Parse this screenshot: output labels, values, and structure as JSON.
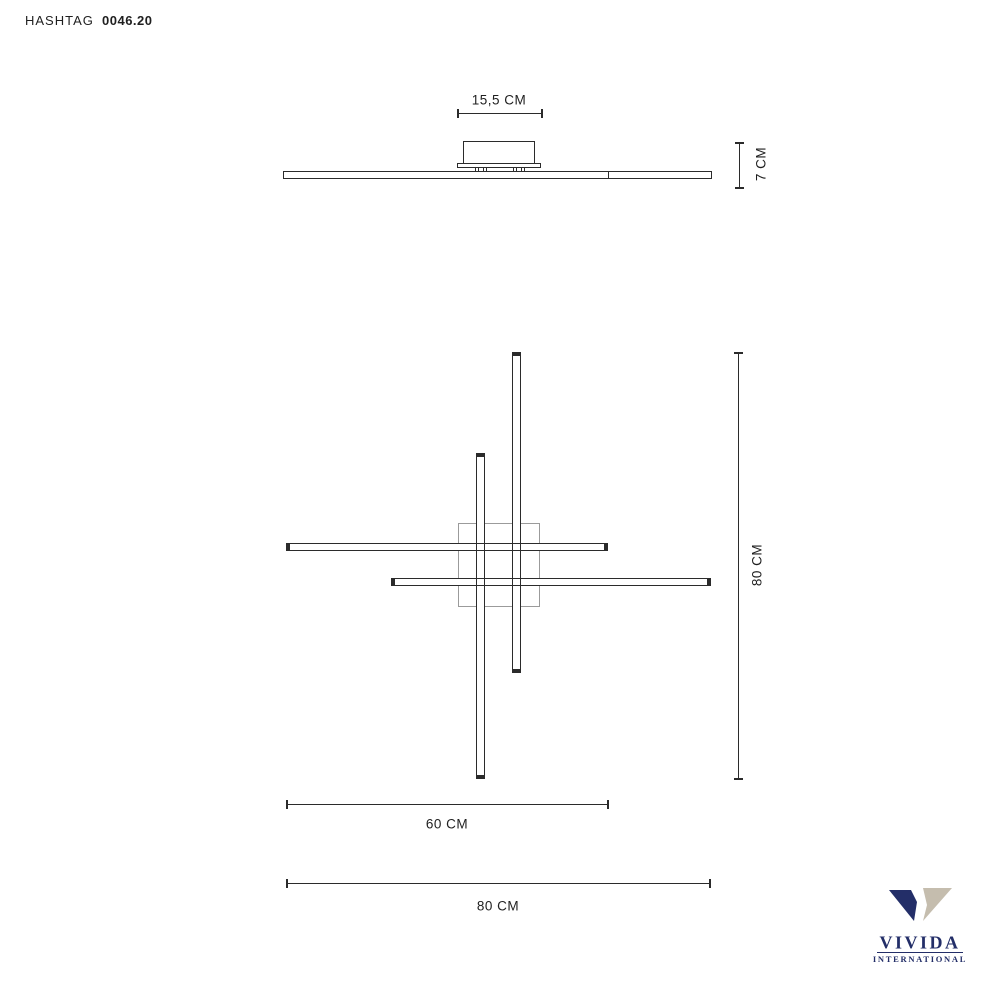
{
  "header": {
    "product_name": "HASHTAG",
    "product_code": "0046.20"
  },
  "side_view": {
    "canopy_width_label": "15,5 CM",
    "height_label": "7 CM"
  },
  "plan_view": {
    "vertical_span_label": "80 CM",
    "inner_width_label": "60 CM",
    "full_width_label": "80 CM"
  },
  "logo": {
    "brand": "VIVIDA",
    "subtitle": "INTERNATIONAL"
  },
  "colors": {
    "drawing_line": "#2b2b2b",
    "canopy_outline": "#9b9b9b",
    "text": "#1f1f1f",
    "logo_navy": "#232e68",
    "logo_beige": "#c5bdae"
  }
}
